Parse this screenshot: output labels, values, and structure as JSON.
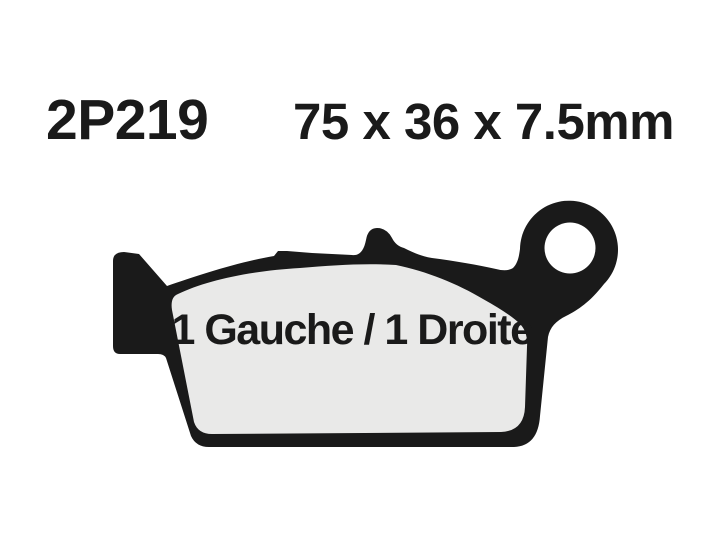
{
  "header": {
    "part_number": "2P219",
    "dimensions": "75 x 36 x 7.5mm"
  },
  "diagram": {
    "type": "brake-pad-outline-drawing",
    "pad_label": "1 Gauche / 1 Droite",
    "colors": {
      "outline": "#1a1a1a",
      "friction_material": "#e9e9e8",
      "hole": "#ffffff",
      "text": "#1a1a1a",
      "background": "#ffffff"
    }
  }
}
